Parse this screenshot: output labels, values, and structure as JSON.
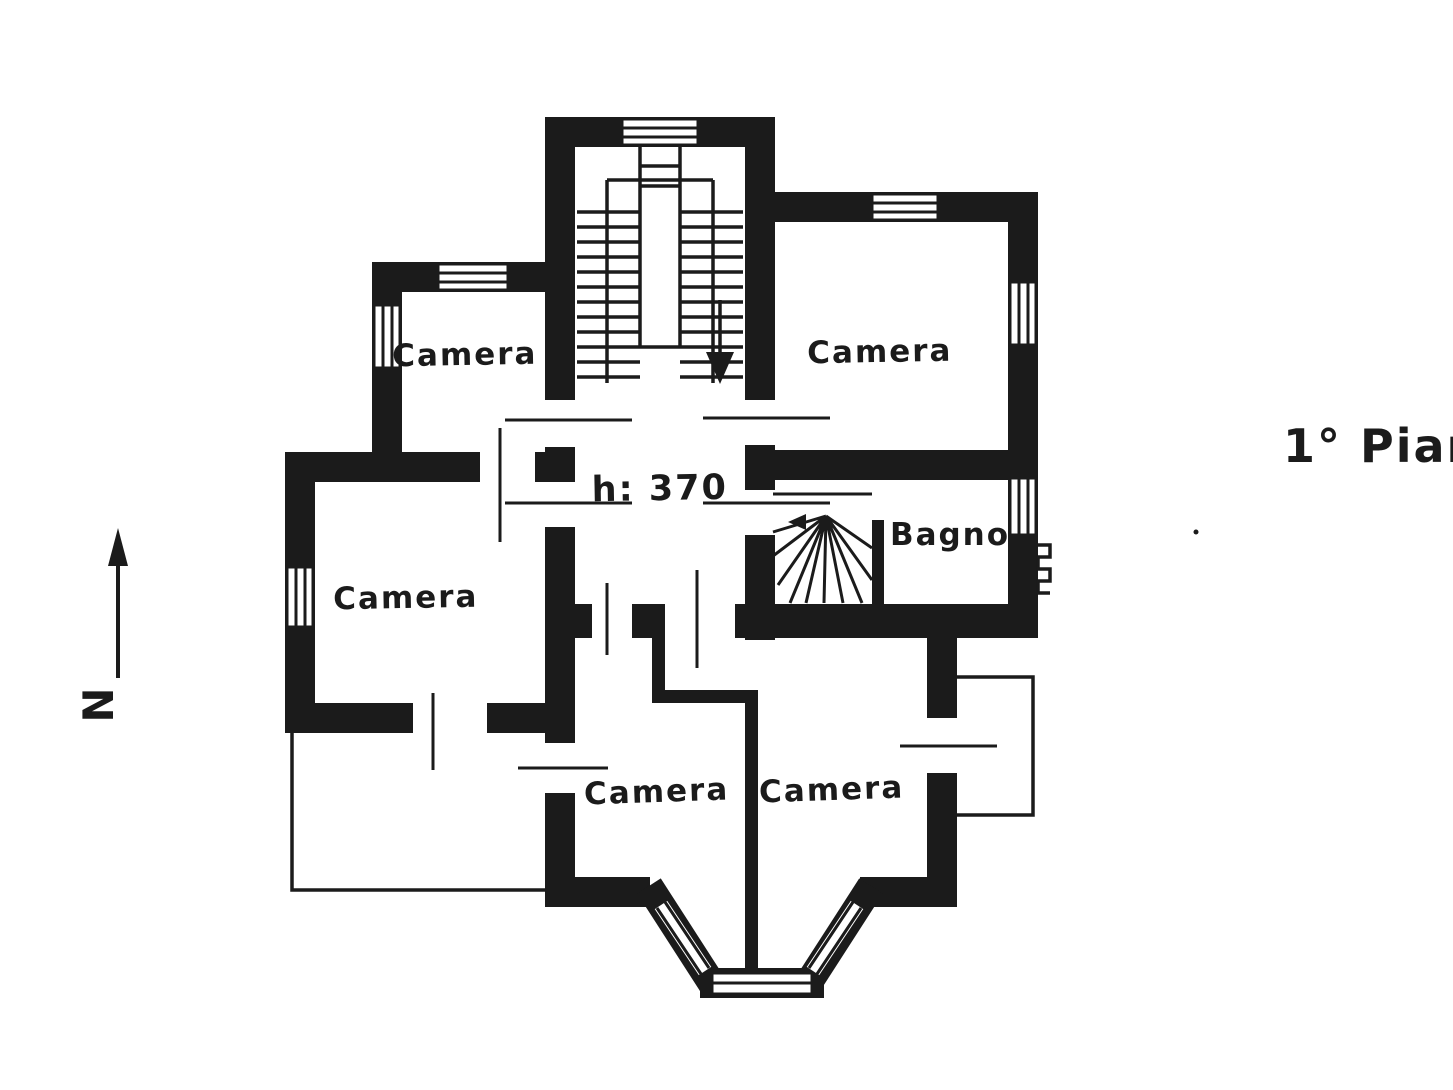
{
  "plan": {
    "floor_label": "1° Pian",
    "north_label": "N",
    "hall": {
      "height_note": "h: 370"
    },
    "rooms": [
      {
        "name": "camera-top-left",
        "label": "Camera"
      },
      {
        "name": "camera-top-right",
        "label": "Camera"
      },
      {
        "name": "camera-mid-left",
        "label": "Camera"
      },
      {
        "name": "camera-bottom-left",
        "label": "Camera"
      },
      {
        "name": "camera-bottom-right",
        "label": "Camera"
      },
      {
        "name": "bagno",
        "label": "Bagno"
      }
    ],
    "colors": {
      "ink": "#1b1b1b",
      "paper": "#ffffff"
    }
  }
}
